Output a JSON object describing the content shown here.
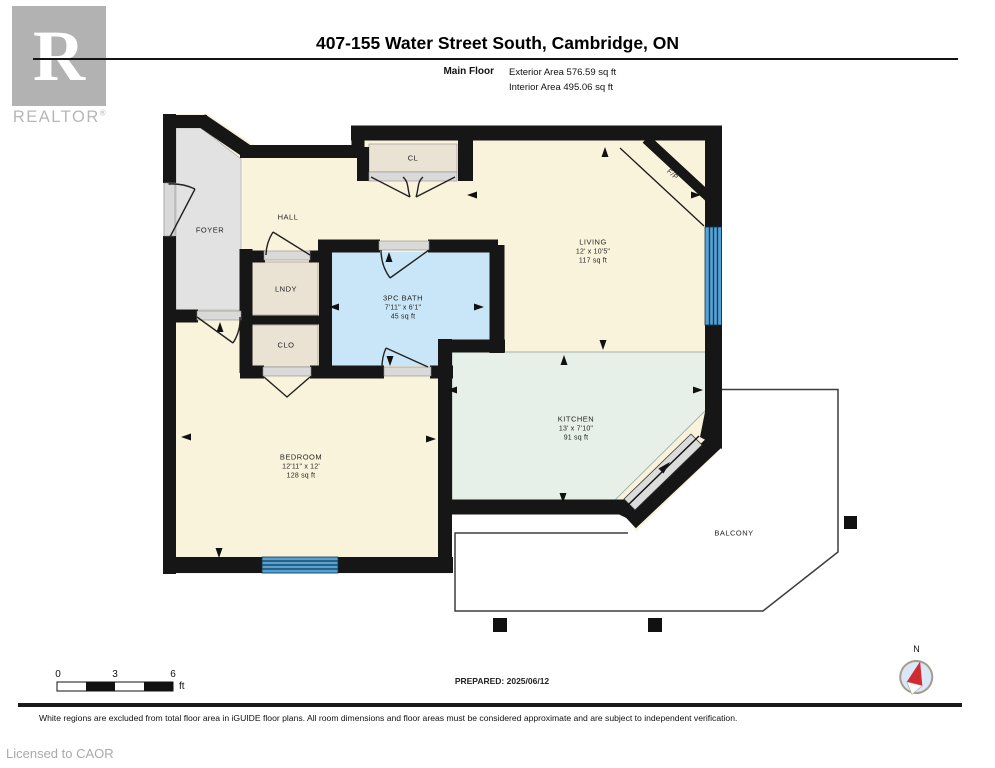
{
  "header": {
    "title": "407-155 Water Street South, Cambridge, ON",
    "floor_label": "Main Floor",
    "exterior": "Exterior Area 576.59 sq ft",
    "interior": "Interior Area 495.06 sq ft"
  },
  "logo": {
    "letter": "R",
    "brand": "REALTOR",
    "reg": "®"
  },
  "rooms": {
    "foyer": {
      "name": "FOYER"
    },
    "hall": {
      "name": "HALL"
    },
    "lndy": {
      "name": "LNDY"
    },
    "clo": {
      "name": "CLO"
    },
    "cl": {
      "name": "CL"
    },
    "fp": {
      "name": "F/P"
    },
    "living": {
      "name": "LIVING",
      "dims": "12' x 10'5\"",
      "area": "117 sq ft"
    },
    "bath": {
      "name": "3PC BATH",
      "dims": "7'11\" x 6'1\"",
      "area": "45 sq ft"
    },
    "kitchen": {
      "name": "KITCHEN",
      "dims": "13' x 7'10\"",
      "area": "91 sq ft"
    },
    "bedroom": {
      "name": "BEDROOM",
      "dims": "12'11\" x 12'",
      "area": "128 sq ft"
    },
    "balcony": {
      "name": "BALCONY"
    }
  },
  "scale_bar": {
    "tick0": "0",
    "tick1": "3",
    "tick2": "6",
    "unit": "ft"
  },
  "compass": {
    "label": "N"
  },
  "footer": {
    "prepared": "PREPARED: 2025/06/12",
    "disclaimer": "White regions are excluded from total floor area in iGUIDE floor plans. All room dimensions and floor areas must be considered approximate and are subject to independent verification.",
    "licensed": "Licensed to CAOR"
  },
  "colors": {
    "wall": "#161616",
    "cream": "#faf3dc",
    "foyer_gray": "#e2e2e2",
    "bath_blue": "#c9e6f8",
    "kitchen_green": "#e7f0e8",
    "closet_tan": "#eae2d2",
    "window_blue": "#55a1d4",
    "compass_red": "#cf2b30"
  }
}
